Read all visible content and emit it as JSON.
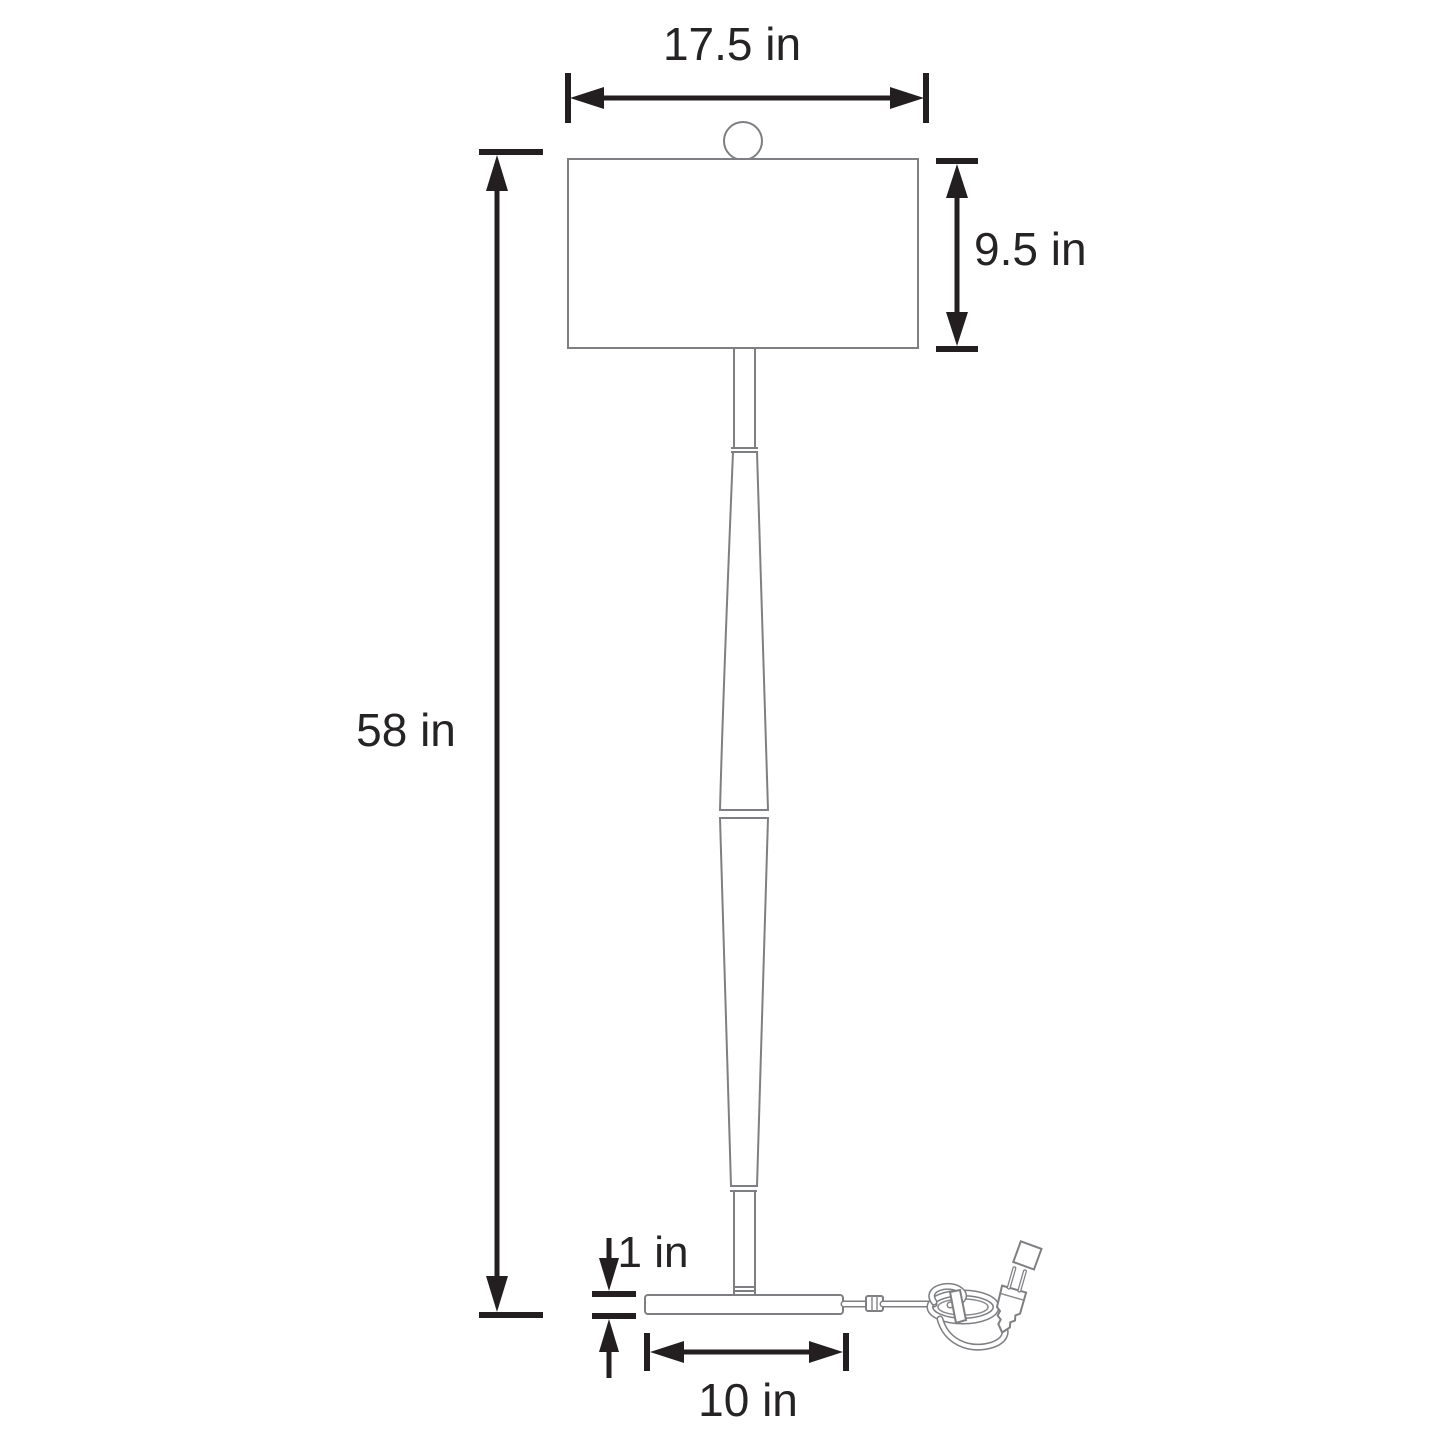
{
  "diagram": {
    "type": "product-dimension-drawing",
    "subject": "floor lamp with drum shade, spindle pole, round base and power cord with plug",
    "background": "#ffffff",
    "colors": {
      "dimension_lines": "#231f20",
      "lamp_outline": "#7e7f82",
      "label_text": "#262324"
    },
    "labels": {
      "shade_width": "17.5 in",
      "shade_height": "9.5 in",
      "total_height": "58 in",
      "base_thickness": "1 in",
      "base_width": "10 in"
    }
  }
}
